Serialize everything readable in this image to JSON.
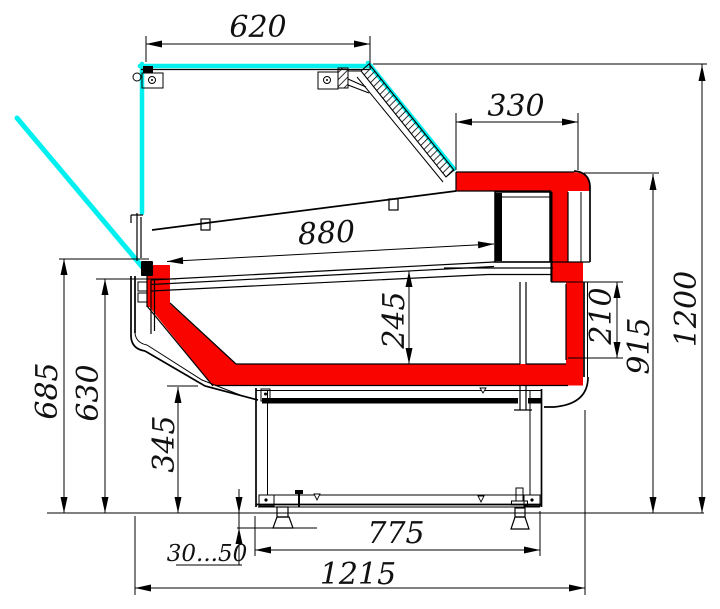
{
  "drawing": {
    "title": "Refrigerated display case cross-section drawing",
    "view": "side section with overall and installation dimensions (mm)",
    "colors": {
      "highlight_profile": "#fa0400",
      "glass_line": "#00f0f0",
      "contour": "#000000",
      "background": "#ffffff"
    },
    "dims": {
      "canopy_width": "620",
      "back_top_depth": "330",
      "deck_length": "880",
      "well_depth": "245",
      "back_step_height": "210",
      "worktop_height": "915",
      "overall_height": "1200",
      "front_height": "685",
      "front_glass_height": "630",
      "base_height": "345",
      "base_depth": "775",
      "leg_adjust_range": "30...50",
      "overall_depth": "1215"
    }
  }
}
